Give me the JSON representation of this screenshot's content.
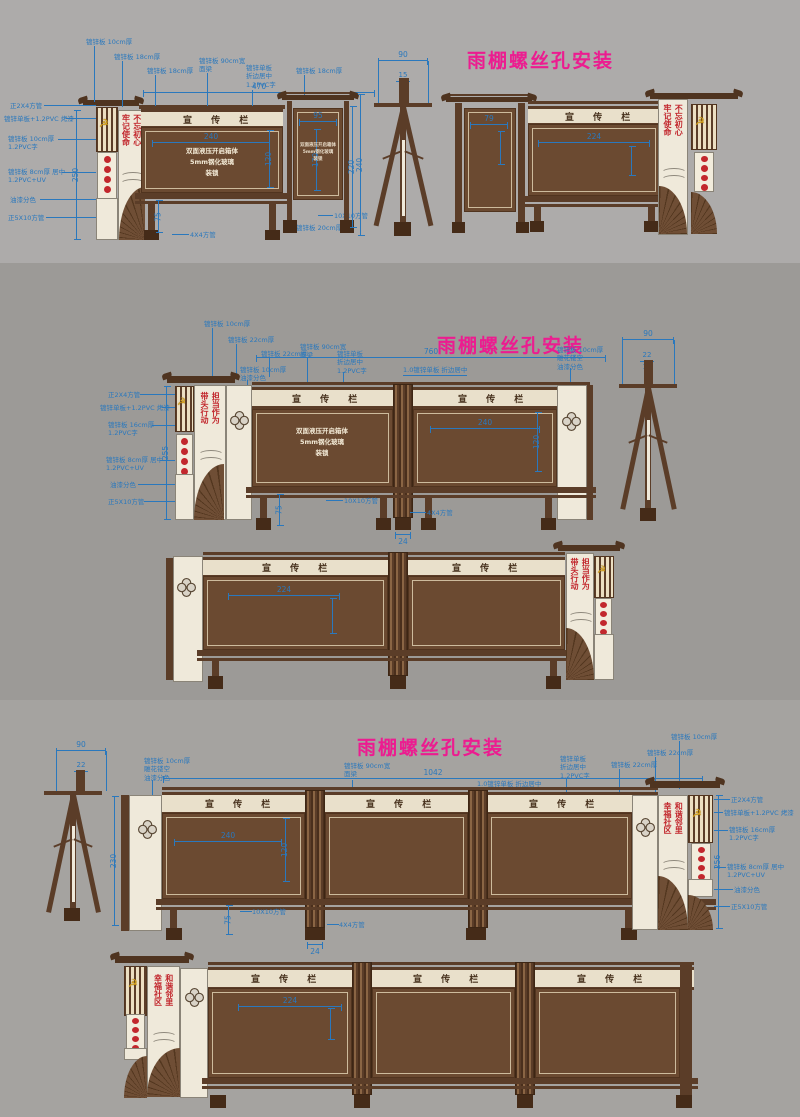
{
  "titles": {
    "t1": "雨棚螺丝孔安装",
    "t2": "雨棚螺丝孔安装",
    "t3": "雨棚螺丝孔安装"
  },
  "board": {
    "header": "宣 传 栏",
    "box1": "双面液压开启箱体",
    "box2": "5mm钢化玻璃",
    "box3": "装锁"
  },
  "slog": {
    "s1l": "牢记使命",
    "s1r": "不忘初心",
    "s2l": "带头行动",
    "s2r": "担当作为",
    "s3l": "幸福社区",
    "s3r": "和谐邻里"
  },
  "icons": {
    "party_emblem": "☭"
  },
  "colors": {
    "dim_blue": "#2a78bd",
    "title_magenta": "#ec1c90",
    "wood_brown": "#5b3d28",
    "cream": "#efe9da",
    "seal_red": "#c2272d",
    "emblem_gold": "#d8a21c"
  },
  "s1": {
    "tl": [
      "镀锌板 10cm厚",
      "镀锌板 18cm厚",
      "镀锌板 18cm厚",
      "镀锌板 90cm宽\n面梁",
      "镀锌单板\n折边居中\n1.2PVC字",
      "镀锌板 18cm厚"
    ],
    "ll": [
      "正2X4方管",
      "镀锌单板+1.2PVC 烤漆",
      "镀锌板 10cm厚\n1.2PVC字",
      "镀锌板 8cm厚 居中\n1.2PVC+UV",
      "油漆分色",
      "正5X10方管"
    ],
    "bl": [
      "4X4方管",
      "10X10方管",
      "镀锌板 20cm厚"
    ],
    "d470": "470",
    "d240": "240",
    "d120": "120",
    "d75": "75",
    "d250": "250",
    "d95": "95",
    "d170": "170",
    "d220": "220",
    "d240b": "240",
    "d90": "90",
    "d15": "15",
    "d10": "10",
    "d79": "79",
    "d224": "224"
  },
  "s2": {
    "tl": [
      "镀锌板 10cm厚",
      "镀锌板 22cm厚",
      "镀锌板 22cm厚",
      "镀锌板 10cm厚\n油漆分色",
      "镀锌板 90cm宽\n面梁",
      "镀锌单板\n折边居中\n1.2PVC字",
      "1.0镀锌单板 折边居中",
      "镀锌板 10cm厚\n雕花镂空\n油漆分色"
    ],
    "ll": [
      "正2X4方管",
      "镀锌单板+1.2PVC 烤漆",
      "镀锌板 16cm厚\n1.2PVC字",
      "镀锌板 8cm厚 居中\n1.2PVC+UV",
      "油漆分色",
      "正5X10方管"
    ],
    "bl": [
      "10X10方管",
      "4X4方管"
    ],
    "d760": "760",
    "d240": "240",
    "d120": "120",
    "d75": "75",
    "d24": "24",
    "d255": "255",
    "d90": "90",
    "d22": "22",
    "d16": "16",
    "d224": "224"
  },
  "s3": {
    "tl": [
      "镀锌板 10cm厚\n雕花镂空\n油漆分色",
      "镀锌板 90cm宽\n面梁",
      "1.0镀锌单板 折边居中",
      "镀锌单板\n折边居中\n1.2PVC字",
      "镀锌板 22cm厚",
      "镀锌板 22cm厚",
      "镀锌板 10cm厚"
    ],
    "rl": [
      "正2X4方管",
      "镀锌单板+1.2PVC 烤漆",
      "镀锌板 16cm厚\n1.2PVC字",
      "镀锌板 8cm厚 居中\n1.2PVC+UV",
      "油漆分色",
      "正5X10方管"
    ],
    "bl": [
      "10X10方管",
      "4X4方管"
    ],
    "d1042": "1042",
    "d240": "240",
    "d120": "120",
    "d75": "75",
    "d24": "24",
    "d230": "230",
    "d256": "256",
    "d90": "90",
    "d22": "22",
    "d16": "16",
    "d224": "224"
  }
}
